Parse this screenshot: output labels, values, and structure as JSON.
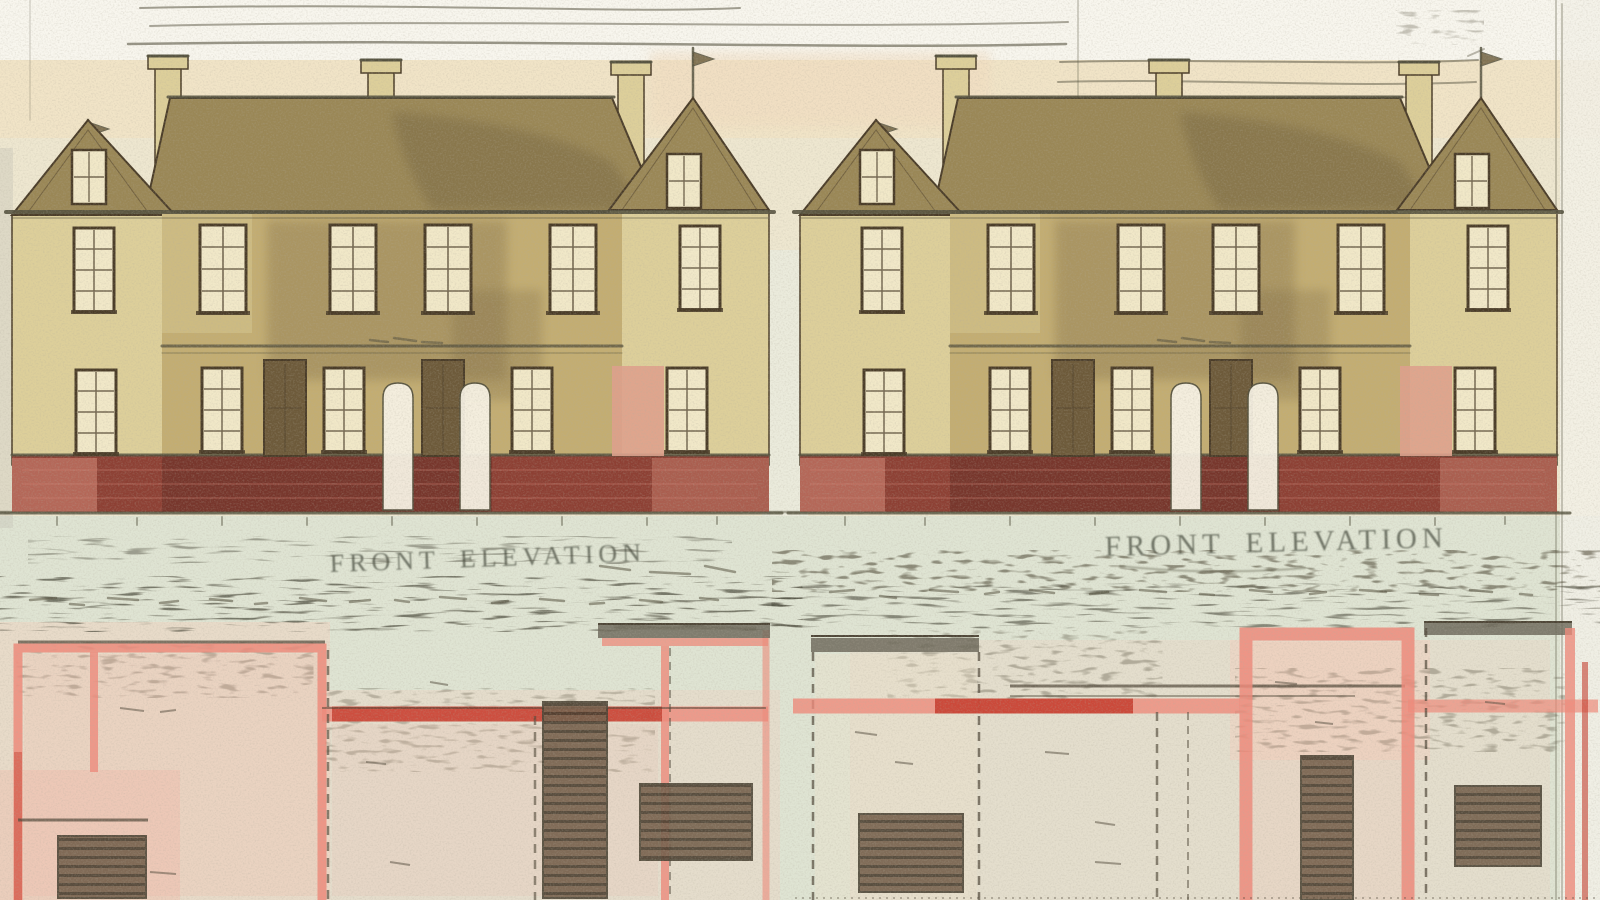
{
  "drawing": {
    "captions": {
      "left": "FRONT ELEVATION",
      "right": "FRONT ELEVATION"
    },
    "elevations": {
      "count": 2,
      "style": "pair of identical two-storey gabled houses"
    },
    "colors": {
      "paper": "#eee7d0",
      "paper_top": "#f8f6ee",
      "paper_warm": "#f1e3c6",
      "paper_green": "#dfe4d3",
      "paper_pink": "#f2d2c0",
      "roof": "#9a8756",
      "roof_dark": "#6e5f3e",
      "wall": "#c3ad72",
      "wall_light": "#ddcf9a",
      "wall_shadow": "#7d6b44",
      "pane": "#f1e8c8",
      "frame": "#4a3c28",
      "door_white": "#f7f2e4",
      "door_dark": "#6d5a3a",
      "salmon": "#dfa08c",
      "plinth": "#8d4034",
      "plinth_dark": "#612b23",
      "plinth_pink": "#cf8272",
      "ink": "#55523f",
      "caption": "#4e5346",
      "plan_pink": "#ef8a7a",
      "plan_red": "#c43b2c",
      "plan_ink": "#4e4637",
      "stair": "#75604c",
      "stair_line": "#4a3f30",
      "gray_cap": "#6e6a5c"
    }
  }
}
